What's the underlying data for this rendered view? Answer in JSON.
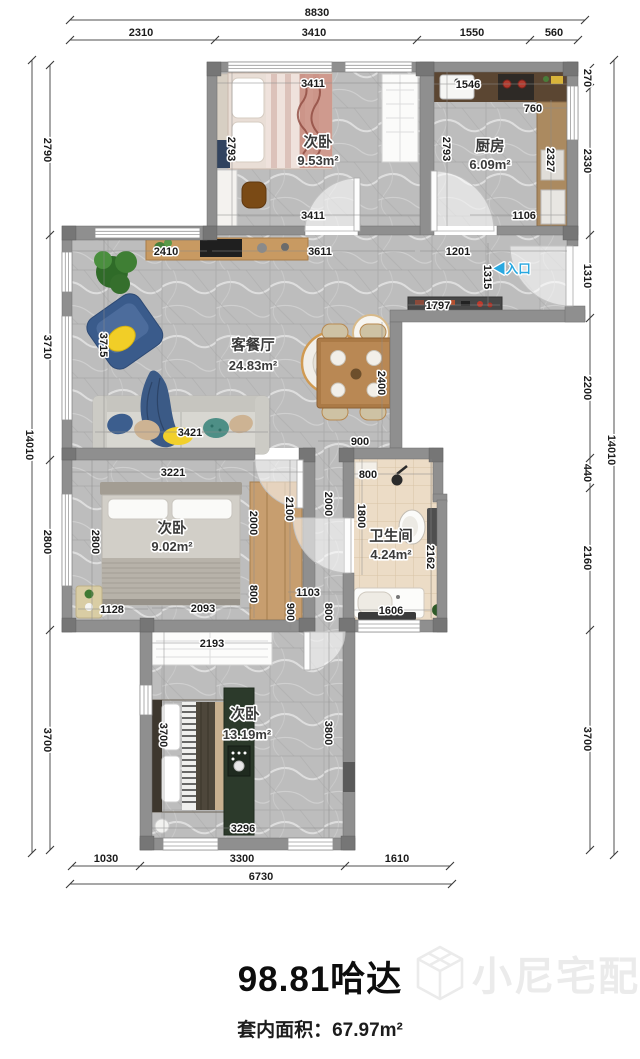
{
  "plan": {
    "colors": {
      "entry_arrow": "#29a8e0",
      "watermark_gray": "#ebebeb",
      "wall_gray": "#8f8f8f"
    },
    "labels": {
      "top_chain": [
        {
          "t": "8830",
          "x": 317,
          "y": 16,
          "c": "dim"
        },
        {
          "t": "2310",
          "x": 141,
          "y": 36,
          "c": "dim"
        },
        {
          "t": "3410",
          "x": 314,
          "y": 36,
          "c": "dim"
        },
        {
          "t": "1550",
          "x": 472,
          "y": 36,
          "c": "dim"
        },
        {
          "t": "560",
          "x": 554,
          "y": 36,
          "c": "dim"
        }
      ],
      "bottom_chain": [
        {
          "t": "1030",
          "x": 106,
          "y": 862,
          "c": "dim"
        },
        {
          "t": "3300",
          "x": 242,
          "y": 862,
          "c": "dim"
        },
        {
          "t": "1610",
          "x": 397,
          "y": 862,
          "c": "dim"
        },
        {
          "t": "6730",
          "x": 261,
          "y": 880,
          "c": "dim"
        }
      ],
      "left_chain": [
        {
          "t": "2790",
          "x": 44,
          "y": 150,
          "c": "dimv",
          "r": 90
        },
        {
          "t": "3710",
          "x": 44,
          "y": 347,
          "c": "dimv",
          "r": 90
        },
        {
          "t": "2800",
          "x": 44,
          "y": 542,
          "c": "dimv",
          "r": 90
        },
        {
          "t": "3700",
          "x": 44,
          "y": 740,
          "c": "dimv",
          "r": 90
        },
        {
          "t": "14010",
          "x": 26,
          "y": 445,
          "c": "dimv",
          "r": 90
        }
      ],
      "right_chain": [
        {
          "t": "270",
          "x": 584,
          "y": 78,
          "c": "dimv",
          "r": 90
        },
        {
          "t": "2330",
          "x": 584,
          "y": 161,
          "c": "dimv",
          "r": 90
        },
        {
          "t": "1310",
          "x": 584,
          "y": 276,
          "c": "dimv",
          "r": 90
        },
        {
          "t": "2200",
          "x": 584,
          "y": 388,
          "c": "dimv",
          "r": 90
        },
        {
          "t": "440",
          "x": 584,
          "y": 473,
          "c": "dimv",
          "r": 90
        },
        {
          "t": "2160",
          "x": 584,
          "y": 558,
          "c": "dimv",
          "r": 90
        },
        {
          "t": "3700",
          "x": 584,
          "y": 739,
          "c": "dimv",
          "r": 90
        },
        {
          "t": "14010",
          "x": 608,
          "y": 450,
          "c": "dimv",
          "r": 90
        }
      ],
      "interior_dims": [
        {
          "t": "3411",
          "x": 313,
          "y": 87,
          "c": "dim"
        },
        {
          "t": "1546",
          "x": 468,
          "y": 88,
          "c": "dim"
        },
        {
          "t": "760",
          "x": 533,
          "y": 112,
          "c": "dim"
        },
        {
          "t": "2793",
          "x": 228,
          "y": 149,
          "c": "dimv",
          "r": 90
        },
        {
          "t": "2793",
          "x": 443,
          "y": 149,
          "c": "dimv",
          "r": 90
        },
        {
          "t": "2327",
          "x": 547,
          "y": 160,
          "c": "dimv",
          "r": 90
        },
        {
          "t": "3411",
          "x": 313,
          "y": 219,
          "c": "dim"
        },
        {
          "t": "1106",
          "x": 524,
          "y": 219,
          "c": "dim"
        },
        {
          "t": "2410",
          "x": 166,
          "y": 255,
          "c": "dim"
        },
        {
          "t": "3611",
          "x": 320,
          "y": 255,
          "c": "dim"
        },
        {
          "t": "1201",
          "x": 458,
          "y": 255,
          "c": "dim"
        },
        {
          "t": "1315",
          "x": 484,
          "y": 277,
          "c": "dimv",
          "r": 90
        },
        {
          "t": "1797",
          "x": 438,
          "y": 309,
          "c": "dim"
        },
        {
          "t": "3715",
          "x": 100,
          "y": 345,
          "c": "dimv",
          "r": 90
        },
        {
          "t": "2400",
          "x": 378,
          "y": 383,
          "c": "dimv",
          "r": 90
        },
        {
          "t": "3421",
          "x": 190,
          "y": 436,
          "c": "dim"
        },
        {
          "t": "900",
          "x": 360,
          "y": 445,
          "c": "dim"
        },
        {
          "t": "3221",
          "x": 173,
          "y": 476,
          "c": "dim"
        },
        {
          "t": "800",
          "x": 368,
          "y": 478,
          "c": "dim"
        },
        {
          "t": "2800",
          "x": 92,
          "y": 542,
          "c": "dimv",
          "r": 90
        },
        {
          "t": "2000",
          "x": 250,
          "y": 523,
          "c": "dimv",
          "r": 90
        },
        {
          "t": "800",
          "x": 250,
          "y": 594,
          "c": "dimv",
          "r": 90
        },
        {
          "t": "2100",
          "x": 286,
          "y": 509,
          "c": "dimv",
          "r": 90
        },
        {
          "t": "2000",
          "x": 325,
          "y": 504,
          "c": "dimv",
          "r": 90
        },
        {
          "t": "1800",
          "x": 358,
          "y": 516,
          "c": "dimv",
          "r": 90
        },
        {
          "t": "2162",
          "x": 427,
          "y": 557,
          "c": "dimv",
          "r": 90
        },
        {
          "t": "1128",
          "x": 112,
          "y": 613,
          "c": "dim"
        },
        {
          "t": "2093",
          "x": 203,
          "y": 612,
          "c": "dim"
        },
        {
          "t": "1103",
          "x": 308,
          "y": 596,
          "c": "dim"
        },
        {
          "t": "900",
          "x": 287,
          "y": 612,
          "c": "dimv",
          "r": 90
        },
        {
          "t": "800",
          "x": 325,
          "y": 612,
          "c": "dimv",
          "r": 90
        },
        {
          "t": "1606",
          "x": 391,
          "y": 614,
          "c": "dim"
        },
        {
          "t": "2193",
          "x": 212,
          "y": 647,
          "c": "dim"
        },
        {
          "t": "3700",
          "x": 160,
          "y": 735,
          "c": "dimv",
          "r": 90
        },
        {
          "t": "3800",
          "x": 325,
          "y": 733,
          "c": "dimv",
          "r": 90
        },
        {
          "t": "3296",
          "x": 243,
          "y": 832,
          "c": "dim"
        }
      ],
      "room_labels": [
        {
          "t": "次卧",
          "x": 318,
          "y": 147,
          "c": "room"
        },
        {
          "t": "9.53m²",
          "x": 318,
          "y": 165,
          "c": "area"
        },
        {
          "t": "厨房",
          "x": 490,
          "y": 151,
          "c": "room"
        },
        {
          "t": "6.09m²",
          "x": 490,
          "y": 169,
          "c": "area"
        },
        {
          "t": "客餐厅",
          "x": 253,
          "y": 350,
          "c": "room"
        },
        {
          "t": "24.83m²",
          "x": 253,
          "y": 370,
          "c": "area"
        },
        {
          "t": "次卧",
          "x": 172,
          "y": 533,
          "c": "room"
        },
        {
          "t": "9.02m²",
          "x": 172,
          "y": 551,
          "c": "area"
        },
        {
          "t": "卫生间",
          "x": 391,
          "y": 541,
          "c": "room"
        },
        {
          "t": "4.24m²",
          "x": 391,
          "y": 559,
          "c": "area"
        },
        {
          "t": "次卧",
          "x": 245,
          "y": 719,
          "c": "room"
        },
        {
          "t": "13.19m²",
          "x": 247,
          "y": 739,
          "c": "area"
        }
      ],
      "entry": [
        {
          "t": "◀入口",
          "x": 512,
          "y": 273,
          "c": "entry"
        }
      ]
    }
  },
  "footer": {
    "title": "98.81哈达",
    "subtitle": "套内面积：67.97m²",
    "watermark": "小尼宅配"
  }
}
